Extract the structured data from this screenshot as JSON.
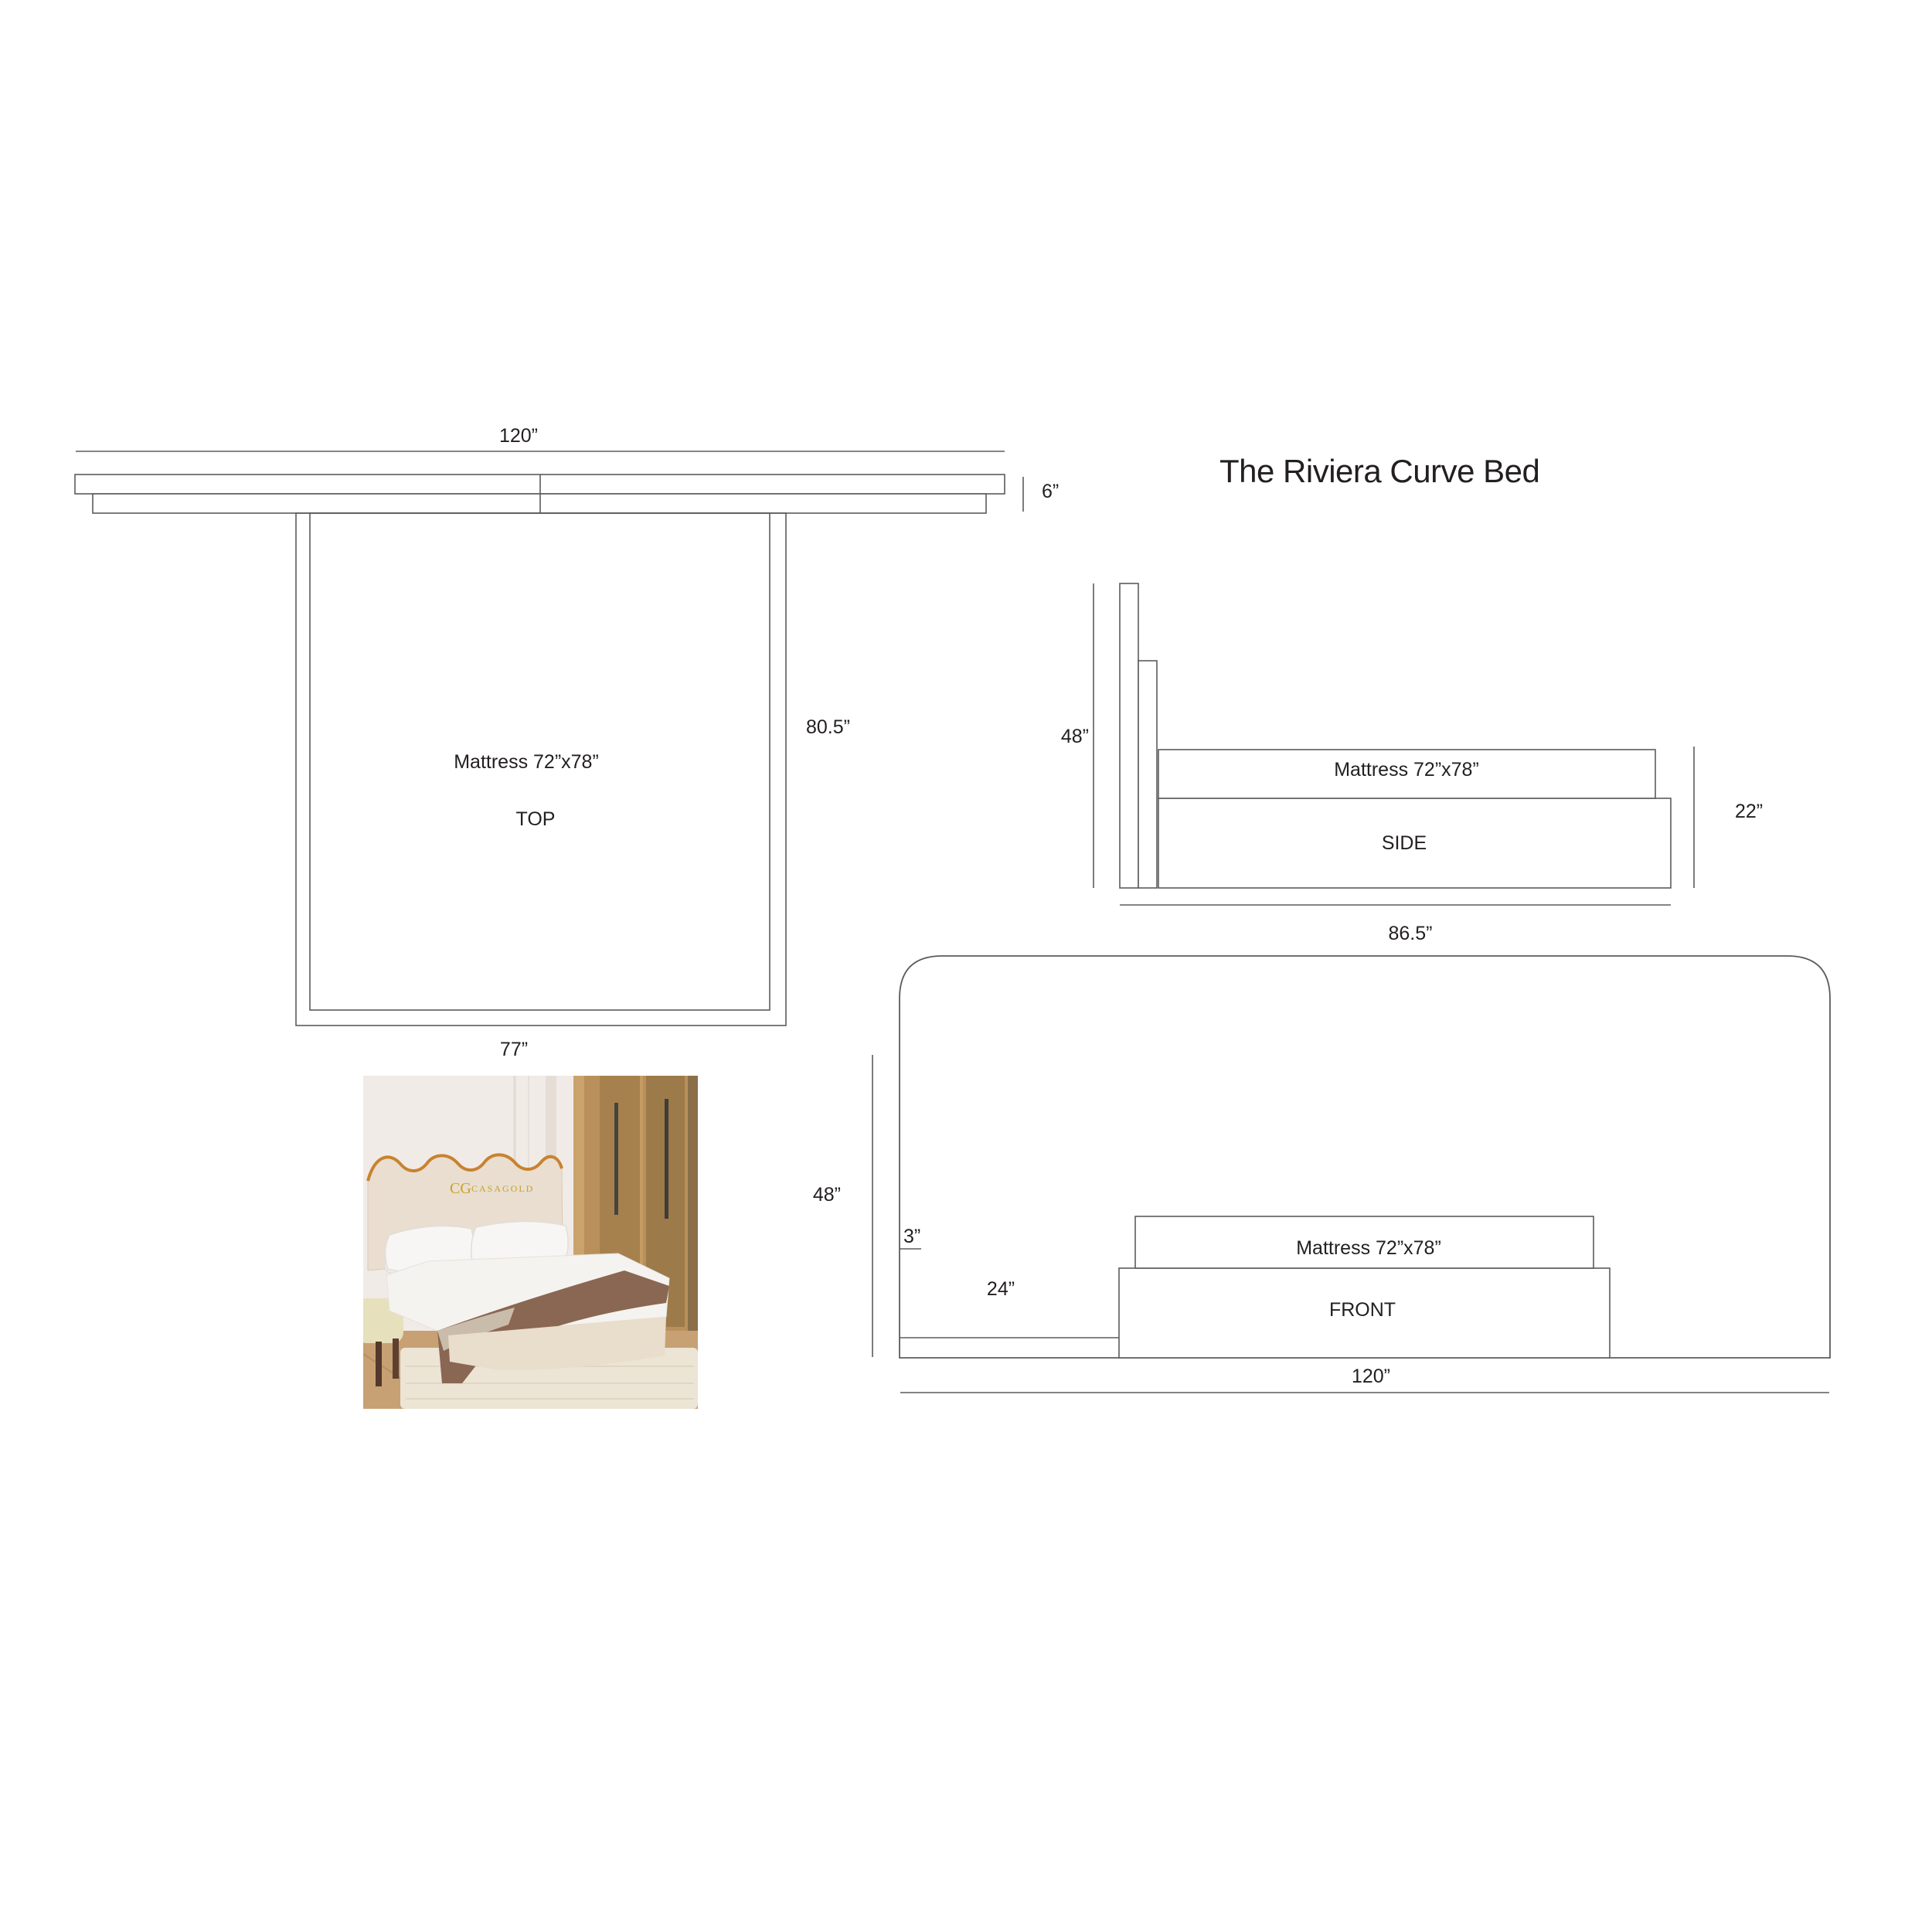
{
  "page": {
    "title": "The Riviera Curve Bed"
  },
  "palette": {
    "line": "#5b5c5e",
    "text": "#231f20",
    "trim": "#c8822f",
    "headboard_fabric": "#e9decf",
    "wardrobe": "#b9905b",
    "wardrobe_dark": "#8a6f49",
    "wall": "#f1ebe7",
    "floor": "#c7a173",
    "rug": "#ece4d5",
    "throw": "#8a6753",
    "bedding": "#f5f3f0",
    "base": "#e9ddcb",
    "gold": "#c9a227"
  },
  "top_view": {
    "width": "120”",
    "headboard_thickness": "6”",
    "length": "80.5”",
    "mattress": "Mattress 72”x78”",
    "label": "TOP",
    "frame_width": "77”"
  },
  "side_view": {
    "height": "48”",
    "mattress": "Mattress 72”x78”",
    "label": "SIDE",
    "base_height": "22”",
    "length": "86.5”"
  },
  "front_view": {
    "height": "48”",
    "trim_gap": "3”",
    "platform_height": "24”",
    "mattress": "Mattress 72”x78”",
    "label": "FRONT",
    "width": "120”"
  },
  "photo": {
    "brand_initials": "CG",
    "brand_name": "CASAGOLD"
  }
}
